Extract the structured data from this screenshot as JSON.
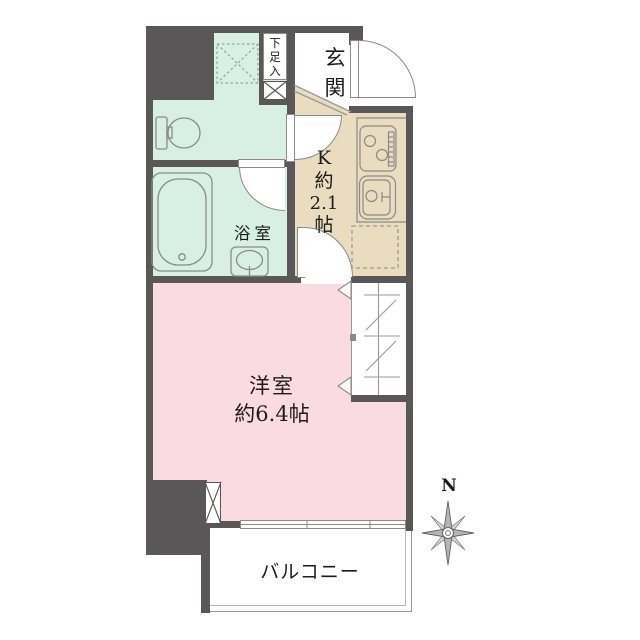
{
  "rooms": {
    "entrance": {
      "name": "玄関",
      "chars": [
        "玄",
        "関"
      ]
    },
    "shoe_storage": {
      "name": "下足入",
      "chars": [
        "下",
        "足",
        "入"
      ]
    },
    "kitchen": {
      "name": "K約2.1帖",
      "chars": [
        "K",
        "約",
        "2.1",
        "帖"
      ],
      "size_tatami": "2.1"
    },
    "bathroom": {
      "name": "浴室"
    },
    "western_room": {
      "name": "洋室",
      "size": "約6.4帖",
      "size_tatami": "6.4"
    },
    "balcony": {
      "name": "バルコニー"
    }
  },
  "compass": {
    "north_label": "N"
  },
  "colors": {
    "wall": "#595757",
    "wet_area_floor": "#d8f0e3",
    "kitchen_floor": "#e9dcbf",
    "room_floor": "#fadbe1",
    "fixture_line": "#8a8a8a"
  },
  "icons": [
    "toilet-icon",
    "bathtub-icon",
    "washbasin-icon",
    "stove-icon",
    "kitchen-sink-icon",
    "refrigerator-space-dashed-icon",
    "washer-space-dashed-icon",
    "shoe-cabinet-x-icon",
    "pipe-shaft-x-icon",
    "door-swing-arc-icon",
    "closet-hanger-icon",
    "sliding-window-icon",
    "compass-rose-icon"
  ]
}
